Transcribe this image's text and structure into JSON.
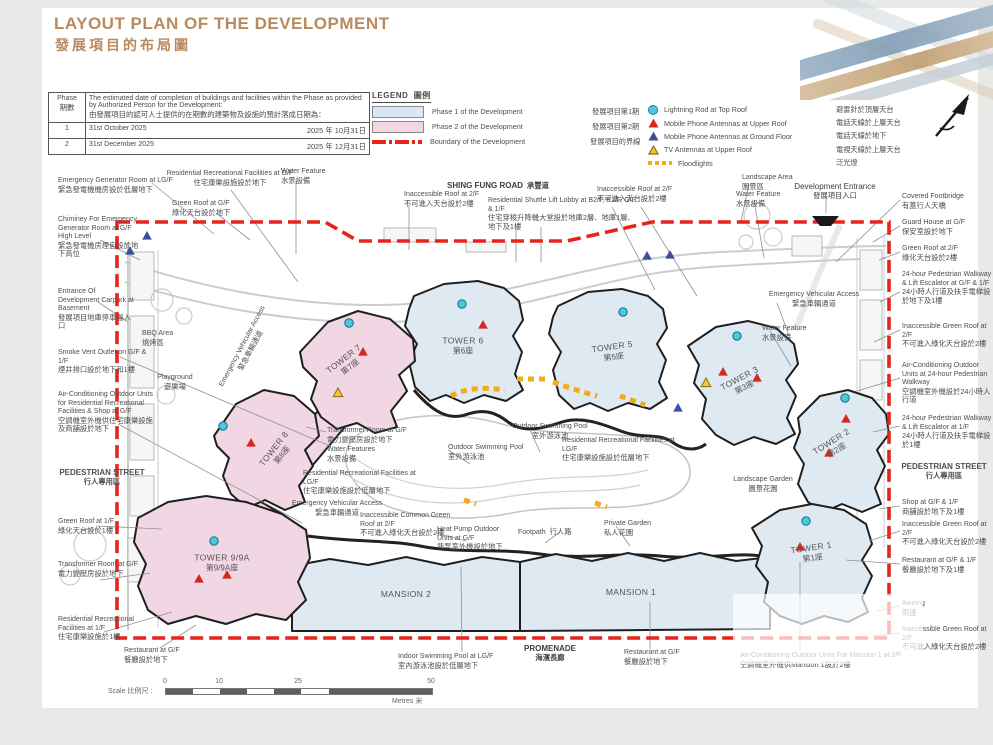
{
  "header": {
    "title_en": "LAYOUT PLAN OF THE DEVELOPMENT",
    "title_zh": "發展項目的布局圖"
  },
  "phase_table": {
    "header_phase_en": "Phase",
    "header_phase_zh": "期數",
    "desc_en": "The estimated date of completion of buildings and facilities within the Phase as provided by Authorized Person for the Development:",
    "desc_zh": "由發展項目的認可人士提供的在期數的建築物及設施的預計落成日期為：",
    "rows": [
      {
        "phase": "1",
        "date_en": "31st October 2025",
        "date_zh": "2025 年 10月31日"
      },
      {
        "phase": "2",
        "date_en": "31st December 2025",
        "date_zh": "2025 年 12月31日"
      }
    ]
  },
  "legend": {
    "title_en": "LEGEND",
    "title_zh": "圖例",
    "items_left": [
      {
        "label_en": "Phase 1 of the Development",
        "label_zh": "發展項目第1期"
      },
      {
        "label_en": "Phase 2 of the Development",
        "label_zh": "發展項目第2期"
      },
      {
        "label_en": "Boundary of the Development",
        "label_zh": "發展項目的界線"
      }
    ],
    "items_right": [
      {
        "symbol": "lightning-rod-icon",
        "label_en": "Lightning Rod at Top Roof",
        "label_zh": "避雷針於頂層天台"
      },
      {
        "symbol": "mobile-antenna-upper-icon",
        "label_en": "Mobile Phone Antennas at Upper Roof",
        "label_zh": "電話天線於上層天台"
      },
      {
        "symbol": "mobile-antenna-ground-icon",
        "label_en": "Mobile Phone Antennas at Ground Floor",
        "label_zh": "電話天線於地下"
      },
      {
        "symbol": "tv-antenna-icon",
        "label_en": "TV Antennas at Upper Roof",
        "label_zh": "電視天線於上層天台"
      },
      {
        "symbol": "floodlight-icon",
        "label_en": "Floodlights",
        "label_zh": "泛光燈"
      }
    ]
  },
  "colors": {
    "phase1_fill": "#dfe9f1",
    "phase2_fill": "#f1d7e3",
    "boundary_red": "#e8231a",
    "floodlight_yellow": "#f0ac19",
    "title_tan": "#b88a5e"
  },
  "map": {
    "annotations": [
      {
        "en": "Emergency Generator Room at LG/F",
        "zh": "緊急發電機機房設於低層地下",
        "x": 58,
        "y": 177,
        "w": 132
      },
      {
        "en": "Chiminey For Emergency Generator Room at G/F High Level",
        "zh": "緊急發電機房煙囪設於地下高位",
        "x": 58,
        "y": 216,
        "w": 84
      },
      {
        "en": "Entrance Of Development Carpark at Basement",
        "zh": "發展項目地庫停車場入口",
        "x": 58,
        "y": 288,
        "w": 80
      },
      {
        "en": "Smoke Vent Outlet on G/F & 1/F",
        "zh": "煙井排口設於地下和1樓",
        "x": 58,
        "y": 349,
        "w": 96
      },
      {
        "en": "Air-Conditioning Outdoor Units for Residential Recreational Facilities & Shop at G/F",
        "zh": "空調機室外機供住宅康樂設施及商舖設於地下",
        "x": 58,
        "y": 391,
        "w": 96
      },
      {
        "en": "PEDESTRIAN STREET",
        "zh": "行人專用區",
        "x": 48,
        "y": 468,
        "w": 108,
        "bold": true,
        "align": "center",
        "size": 8
      },
      {
        "en": "Green Roof at 1/F",
        "zh": "綠化天台設於1樓",
        "x": 58,
        "y": 518,
        "w": 112
      },
      {
        "en": "Transformer Room at G/F",
        "zh": "電力變壓房設於地下",
        "x": 58,
        "y": 561,
        "w": 86
      },
      {
        "en": "Residential Recreational Facilities at 1/F",
        "zh": "住宅康樂設施於1樓",
        "x": 58,
        "y": 616,
        "w": 86
      },
      {
        "en": "Residential Recreational Facilities at G/F",
        "zh": "住宅康樂設施設於地下",
        "x": 166,
        "y": 170,
        "w": 128,
        "align": "center"
      },
      {
        "en": "Green Roof at G/F",
        "zh": "綠化天台設於地下",
        "x": 172,
        "y": 200,
        "w": 100
      },
      {
        "en": "Water Feature",
        "zh": "水景設備",
        "x": 281,
        "y": 168,
        "w": 72
      },
      {
        "en": "Inaccessible Roof at 2/F",
        "zh": "不可進入天台設於2樓",
        "x": 404,
        "y": 191,
        "w": 140,
        "nowrap": true
      },
      {
        "en": "SHING FUNG ROAD",
        "zh": "承豐道",
        "x": 447,
        "y": 181,
        "w": 180,
        "bold": true,
        "inline": true,
        "size": 8,
        "color": "#3d3d3d"
      },
      {
        "en": "Residential Shuttle Lift Lobby at B2/F, B1/F, G/F & 1/F",
        "zh": "住宅穿梭升降機大堂設於地庫2層、地庫1層、地下及1樓",
        "x": 488,
        "y": 197,
        "w": 152
      },
      {
        "en": "Inaccessible Roof at 2/F",
        "zh": "不可進入天台設於2樓",
        "x": 597,
        "y": 186,
        "w": 86
      },
      {
        "en": "Landscape Area",
        "zh": "園景區",
        "x": 742,
        "y": 174,
        "w": 92
      },
      {
        "en": "Water Feature",
        "zh": "水景設備",
        "x": 736,
        "y": 191,
        "w": 72
      },
      {
        "en": "Development Entrance",
        "zh": "發展項目入口",
        "x": 770,
        "y": 182,
        "w": 130,
        "align": "center",
        "size": 8,
        "color": "#3d3d3d"
      },
      {
        "en": "Covered Footbridge",
        "zh": "有蓋行人天橋",
        "x": 902,
        "y": 193,
        "w": 92
      },
      {
        "en": "Guard House at G/F",
        "zh": "保安室設於地下",
        "x": 902,
        "y": 219,
        "w": 92
      },
      {
        "en": "Green Roof at 2/F",
        "zh": "綠化天台設於2樓",
        "x": 902,
        "y": 245,
        "w": 92
      },
      {
        "en": "24-hour Pedestrian Walkway & Lift Escalator at G/F & 1/F",
        "zh": "24小時人行道及扶手電梯設於地下及1樓",
        "x": 902,
        "y": 271,
        "w": 90
      },
      {
        "en": "Inaccessible Green Roof at 2/F",
        "zh": "不可進入綠化天台設於2樓",
        "x": 902,
        "y": 323,
        "w": 90
      },
      {
        "en": "Air-Conditioning Outdoor Units at 24-hour Pedestrian Walkway",
        "zh": "空調機室外機設於24小時人行道",
        "x": 902,
        "y": 362,
        "w": 94
      },
      {
        "en": "24-hour Pedestrian Walkway & Lift Escalator at 1/F",
        "zh": "24小時人行道及扶手電梯設於1樓",
        "x": 902,
        "y": 415,
        "w": 90
      },
      {
        "en": "PEDESTRIAN STREET",
        "zh": "行人專用區",
        "x": 896,
        "y": 462,
        "w": 96,
        "bold": true,
        "align": "center",
        "size": 8
      },
      {
        "en": "Shop at G/F & 1/F",
        "zh": "商舖設於地下及1樓",
        "x": 902,
        "y": 499,
        "w": 92
      },
      {
        "en": "Inaccessible Green Roof at 2/F",
        "zh": "不可進入綠化天台設於2樓",
        "x": 902,
        "y": 521,
        "w": 90
      },
      {
        "en": "Restaurant at G/F & 1/F",
        "zh": "餐廳設於地下及1樓",
        "x": 902,
        "y": 557,
        "w": 96
      },
      {
        "en": "Awning",
        "zh": "雨篷",
        "x": 902,
        "y": 600,
        "w": 60
      },
      {
        "en": "Inaccessible Green Roof at 2/F",
        "zh": "不可進入綠化天台設於2樓",
        "x": 902,
        "y": 626,
        "w": 90
      },
      {
        "en": "BBQ Area",
        "zh": "燒烤區",
        "x": 142,
        "y": 330,
        "w": 62
      },
      {
        "en": "Playground",
        "zh": "遊樂場",
        "x": 139,
        "y": 374,
        "w": 72,
        "align": "center"
      },
      {
        "en": "Emergency Vehicular Access",
        "zh": "緊急車輛通道",
        "x": 192,
        "y": 340,
        "w": 110,
        "rot": -62,
        "align": "center",
        "nowrap": true
      },
      {
        "en": "Transformer Room at G/F",
        "zh": "電力變壓房設於地下",
        "x": 327,
        "y": 427,
        "w": 112,
        "nowrap": true
      },
      {
        "en": "Water Features",
        "zh": "水景設備",
        "x": 327,
        "y": 446,
        "w": 112
      },
      {
        "en": "Residential Recreational Facilities at LG/F",
        "zh": "住宅康樂設施設於低層地下",
        "x": 303,
        "y": 470,
        "w": 122
      },
      {
        "en": "Emergency Vehicular Access",
        "zh": "緊急車輛通道",
        "x": 275,
        "y": 500,
        "w": 124,
        "align": "center"
      },
      {
        "en": "Inaccessible Common Green Roof at 2/F",
        "zh": "不可進入綠化天台設於2樓",
        "x": 360,
        "y": 512,
        "w": 100
      },
      {
        "en": "Outdoor Swimming Pool",
        "zh": "室外游泳池",
        "x": 448,
        "y": 444,
        "w": 118
      },
      {
        "en": "Outdoor Swimming Pool",
        "zh": "室外游泳池",
        "x": 494,
        "y": 423,
        "w": 112,
        "align": "center"
      },
      {
        "en": "Residential Recreational Facilities at LG/F",
        "zh": "住宅康樂設施設於低層地下",
        "x": 562,
        "y": 437,
        "w": 128
      },
      {
        "en": "Landscape Garden",
        "zh": "園景花園",
        "x": 714,
        "y": 476,
        "w": 98,
        "align": "center"
      },
      {
        "en": "Water Feature",
        "zh": "水景設備",
        "x": 762,
        "y": 325,
        "w": 72
      },
      {
        "en": "Emergency Vehicular Access",
        "zh": "緊急車輛通道",
        "x": 760,
        "y": 291,
        "w": 108,
        "align": "center"
      },
      {
        "en": "Heat Pump Outdoor Units at G/F",
        "zh": "熱泵室外機設於地下",
        "x": 437,
        "y": 526,
        "w": 80
      },
      {
        "en": "Footpath",
        "zh": "行人路",
        "x": 518,
        "y": 528,
        "w": 90,
        "inline": true
      },
      {
        "en": "Private Garden",
        "zh": "私人花園",
        "x": 604,
        "y": 520,
        "w": 88
      },
      {
        "en": "Indoor Swimming Pool at LG/F",
        "zh": "室內游泳池設於低層地下",
        "x": 398,
        "y": 653,
        "w": 170,
        "nowrap": true
      },
      {
        "en": "PROMENADE",
        "zh": "海濱長廊",
        "x": 505,
        "y": 644,
        "w": 90,
        "bold": true,
        "align": "center",
        "size": 8,
        "color": "#3d3d3d"
      },
      {
        "en": "Restaurant at G/F",
        "zh": "餐廳設於地下",
        "x": 624,
        "y": 649,
        "w": 88
      },
      {
        "en": "Air-Conditioning Outdoor Units For Mansion 1 at 2/F",
        "zh": "空調機室外機供Mansion 1設於2樓",
        "x": 740,
        "y": 652,
        "w": 220,
        "nowrap": true
      },
      {
        "en": "Restaurant at G/F",
        "zh": "餐廳設於地下",
        "x": 124,
        "y": 647,
        "w": 88
      }
    ],
    "towers": [
      {
        "en": "TOWER 7",
        "zh": "第7座",
        "x": 347,
        "y": 363,
        "rot": -38
      },
      {
        "en": "TOWER 6",
        "zh": "第6座",
        "x": 463,
        "y": 346,
        "rot": 0
      },
      {
        "en": "TOWER 5",
        "zh": "第5座",
        "x": 613,
        "y": 352,
        "rot": -8
      },
      {
        "en": "TOWER 3",
        "zh": "第3座",
        "x": 742,
        "y": 383,
        "rot": -28
      },
      {
        "en": "TOWER 2",
        "zh": "第2座",
        "x": 834,
        "y": 446,
        "rot": -32
      },
      {
        "en": "TOWER 1",
        "zh": "第1座",
        "x": 812,
        "y": 553,
        "rot": -8
      },
      {
        "en": "TOWER 8",
        "zh": "第8座",
        "x": 278,
        "y": 452,
        "rot": -52
      },
      {
        "en": "TOWER 9/9A",
        "zh": "第9/9A座",
        "x": 222,
        "y": 563,
        "rot": 0
      },
      {
        "en": "MANSION 2",
        "zh": "",
        "x": 406,
        "y": 594,
        "rot": 0
      },
      {
        "en": "MANSION 1",
        "zh": "",
        "x": 631,
        "y": 592,
        "rot": 0
      }
    ],
    "symbols": [
      {
        "t": "lightning",
        "x": 349,
        "y": 323
      },
      {
        "t": "lightning",
        "x": 462,
        "y": 304
      },
      {
        "t": "lightning",
        "x": 623,
        "y": 312
      },
      {
        "t": "lightning",
        "x": 737,
        "y": 336
      },
      {
        "t": "lightning",
        "x": 845,
        "y": 398
      },
      {
        "t": "lightning",
        "x": 223,
        "y": 426
      },
      {
        "t": "lightning",
        "x": 214,
        "y": 541
      },
      {
        "t": "lightning",
        "x": 806,
        "y": 521
      },
      {
        "t": "red",
        "x": 363,
        "y": 352
      },
      {
        "t": "red",
        "x": 483,
        "y": 325
      },
      {
        "t": "red",
        "x": 723,
        "y": 372
      },
      {
        "t": "red",
        "x": 757,
        "y": 378
      },
      {
        "t": "red",
        "x": 846,
        "y": 419
      },
      {
        "t": "red",
        "x": 829,
        "y": 453
      },
      {
        "t": "red",
        "x": 251,
        "y": 443
      },
      {
        "t": "red",
        "x": 199,
        "y": 579
      },
      {
        "t": "red",
        "x": 227,
        "y": 575
      },
      {
        "t": "red",
        "x": 800,
        "y": 547
      },
      {
        "t": "blue",
        "x": 147,
        "y": 236
      },
      {
        "t": "blue",
        "x": 130,
        "y": 251
      },
      {
        "t": "blue",
        "x": 647,
        "y": 256
      },
      {
        "t": "blue",
        "x": 670,
        "y": 255
      },
      {
        "t": "blue",
        "x": 678,
        "y": 408
      },
      {
        "t": "yellow",
        "x": 338,
        "y": 393
      },
      {
        "t": "yellow",
        "x": 706,
        "y": 383
      }
    ]
  },
  "scale": {
    "label_en": "Scale",
    "label_zh": "比例尺 :",
    "ticks": [
      "0",
      "10",
      "25",
      "50"
    ],
    "unit_en": "Metres",
    "unit_zh": "米"
  }
}
